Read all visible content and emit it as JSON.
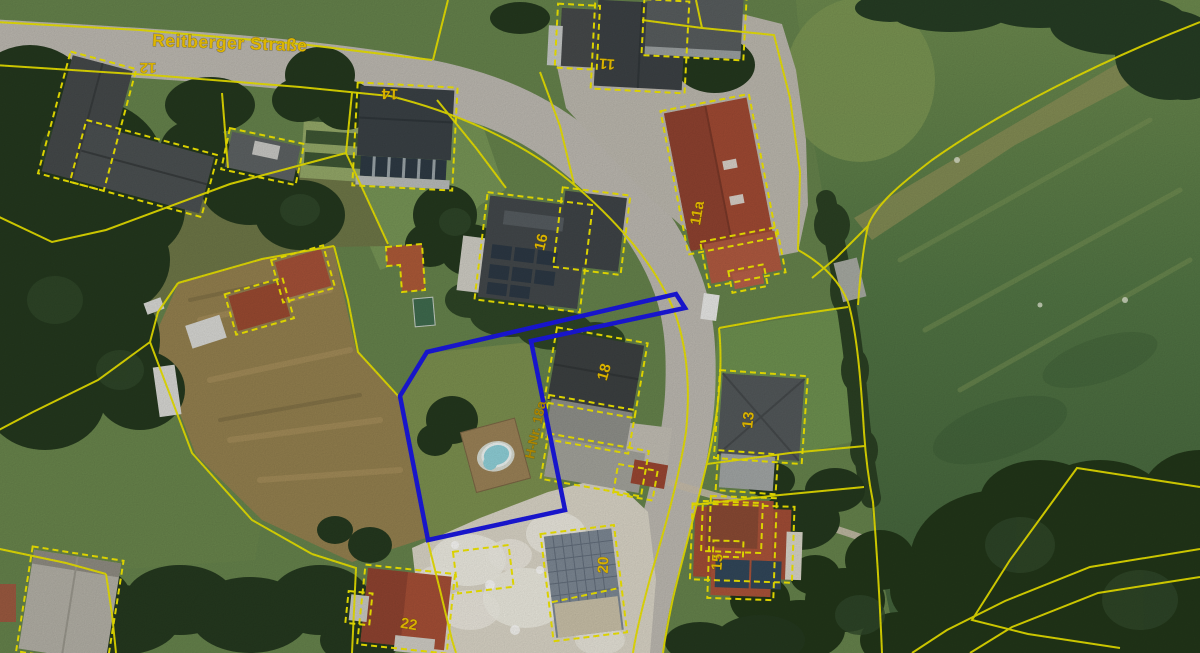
{
  "map": {
    "street_label": "Reitberger Straße",
    "highlight": {
      "label": "H-Nr. 18a",
      "color": "#1b18e0",
      "label_color": "#bd9300"
    },
    "building_labels": [
      {
        "house_number": "12"
      },
      {
        "house_number": "14"
      },
      {
        "house_number": "11"
      },
      {
        "house_number": "11a"
      },
      {
        "house_number": "16"
      },
      {
        "house_number": "18"
      },
      {
        "house_number": "13"
      },
      {
        "house_number": "15"
      },
      {
        "house_number": "20"
      },
      {
        "house_number": "22"
      }
    ],
    "colors": {
      "parcel_line": "#ece400",
      "building_outline": "#f2e800",
      "label": "#f0c400",
      "street_label": "#f5c800"
    }
  }
}
